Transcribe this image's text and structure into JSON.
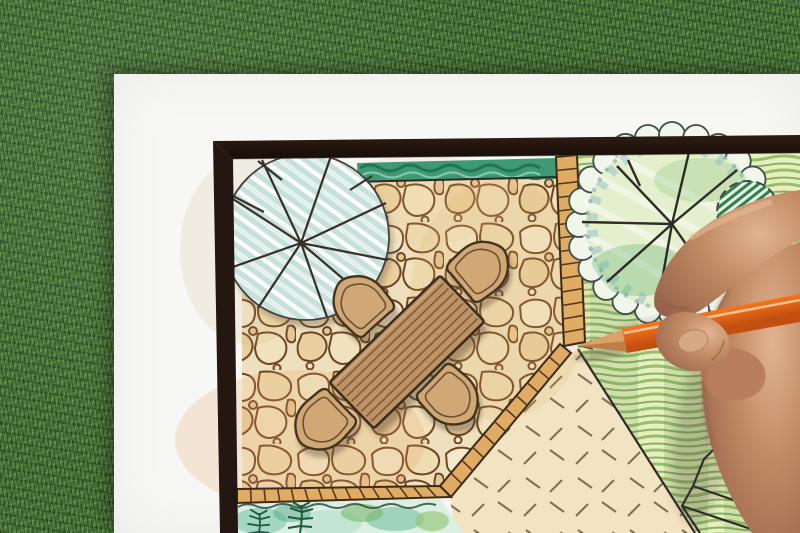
{
  "scene": {
    "type": "photograph",
    "description": "Overhead photo of a hand holding an orange colored pencil, drawing a garden landscape architecture plan on a white sheet of paper that lies on green artificial grass",
    "plan_contents": "flagstone patio with rectangular wood table and four chairs, round tree symbol, clipped hedge strip, scalloped tree canopy over lawn, paver tile edging, groundcover planting bed with fern, dashed stepping area"
  },
  "objects": {
    "background": "artificial-grass-lawn",
    "sheet": "white-paper-sheet",
    "border": "dark-drawing-frame",
    "paving": "flagstone-patio",
    "hedge": "green-hedge-strip",
    "tree_left": "round-tree-symbol-striped",
    "tree_right": "scalloped-tree-canopy",
    "shrub": "hatched-shrub-symbol",
    "furniture": "wood-table-with-chairs",
    "edging": "paver-tile-edging",
    "lawn": "hatched-lawn-area",
    "bed": "groundcover-bed-with-fern",
    "steps": "dashed-stepping-area",
    "corner_planting": "corner-planting-cluster",
    "hand": "designer-right-hand",
    "pencil": "orange-colored-pencil"
  },
  "counts": {
    "patio_chairs": 4,
    "table_planks": 8,
    "tree_symbols": 3
  },
  "colors": {
    "grass_base": "#47703a",
    "paper": "#f7f8f6",
    "frame_dark": "#241711",
    "stone_mortar": "#efe0bd",
    "stone_outline": "#6f4524",
    "tile_strip": "#e0ac64",
    "tile_rung": "#59371c",
    "hedge_green": "#3f9a74",
    "hedge_dark": "#1c6b4d",
    "tree_stripe": "#c6e0da",
    "tree_line": "#37302a",
    "table_wood": "#bd9265",
    "plank_line": "#7c5c39",
    "chair_wood": "#cfa876",
    "chair_outline": "#43331f",
    "lawn_base": "#e7efbe",
    "lawn_hatch": "#8db964",
    "lawn_hatch_dark": "#70a24e",
    "canopy_edge": "#3f4d49",
    "canopy_teal": "#6fa8bf",
    "bush_green": "#2f7d52",
    "bed_teal": "#8fcdb9",
    "fern_green": "#1d5c38",
    "dash_fill": "#f2e4c2",
    "dash_stroke": "#6b5b3e",
    "pencil_orange": "#f2711c",
    "pencil_orange_light": "#ffa34f",
    "pencil_orange_dark": "#c24e10",
    "pencil_wood": "#dea06a",
    "skin_base": "#c08a63",
    "skin_shadow": "#96614a",
    "skin_highlight": "#e2b490",
    "ink": "#2e2a25"
  }
}
